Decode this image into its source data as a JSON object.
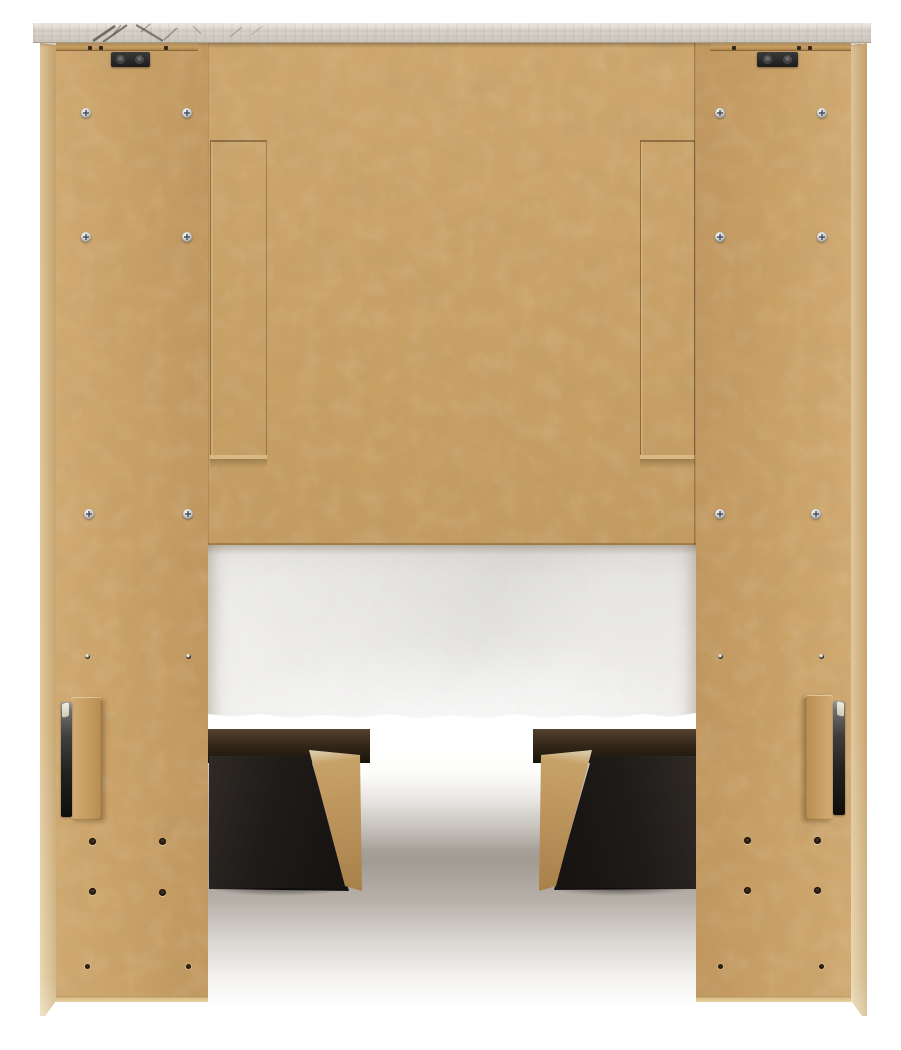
{
  "scene": {
    "description": "Rear product photo of a bookcase storage bed: tan MDF back panels and side piers, whitewashed marble-look top cap with dark veining at left, white mattress foundation visible through the center opening, tan platform deck rail, and two dark storage drawer boxes with angled tan side boards above a shadowed floor.",
    "background": "plain white studio background"
  },
  "colors": {
    "bg": "#ffffff",
    "mdf-face": "#c9a268",
    "mdf-back": "#c8a167",
    "mdf-cleat": "#c59e63",
    "mdf-edge": "#d7b981",
    "cap-face": "#d6d0c7",
    "cap-top": "#e2ddd4",
    "cap-vein": "#4e4c47",
    "bracket": "#1c1c1c",
    "screw-silver": "#c6cad0",
    "drawer-black": "#121010",
    "board-tan": "#b9915a",
    "foundation": "#ebeae8",
    "floor-mid": "#a39c94"
  },
  "hardware": {
    "silver_screws": [
      {
        "x": 86,
        "y": 113
      },
      {
        "x": 187,
        "y": 113
      },
      {
        "x": 86,
        "y": 237
      },
      {
        "x": 187,
        "y": 237
      },
      {
        "x": 89,
        "y": 514
      },
      {
        "x": 188,
        "y": 514
      },
      {
        "x": 720,
        "y": 113
      },
      {
        "x": 822,
        "y": 113
      },
      {
        "x": 720,
        "y": 237
      },
      {
        "x": 822,
        "y": 237
      },
      {
        "x": 720,
        "y": 514
      },
      {
        "x": 816,
        "y": 514
      }
    ],
    "pin_holes": [
      {
        "x": 87,
        "y": 656
      },
      {
        "x": 188,
        "y": 656
      },
      {
        "x": 720,
        "y": 656
      },
      {
        "x": 821,
        "y": 656
      }
    ],
    "dowel_holes": [
      {
        "x": 92,
        "y": 841
      },
      {
        "x": 162,
        "y": 841
      },
      {
        "x": 92,
        "y": 891
      },
      {
        "x": 162,
        "y": 892
      },
      {
        "x": 747,
        "y": 840
      },
      {
        "x": 817,
        "y": 840
      },
      {
        "x": 747,
        "y": 890
      },
      {
        "x": 817,
        "y": 890
      }
    ],
    "pilot_holes": [
      {
        "x": 87,
        "y": 966
      },
      {
        "x": 188,
        "y": 966
      },
      {
        "x": 720,
        "y": 966
      },
      {
        "x": 821,
        "y": 966
      }
    ],
    "rail_pins": [
      {
        "x": 90,
        "y": 48
      },
      {
        "x": 101,
        "y": 48
      },
      {
        "x": 166,
        "y": 48
      },
      {
        "x": 734,
        "y": 48
      },
      {
        "x": 799,
        "y": 48
      },
      {
        "x": 810,
        "y": 48
      }
    ]
  }
}
